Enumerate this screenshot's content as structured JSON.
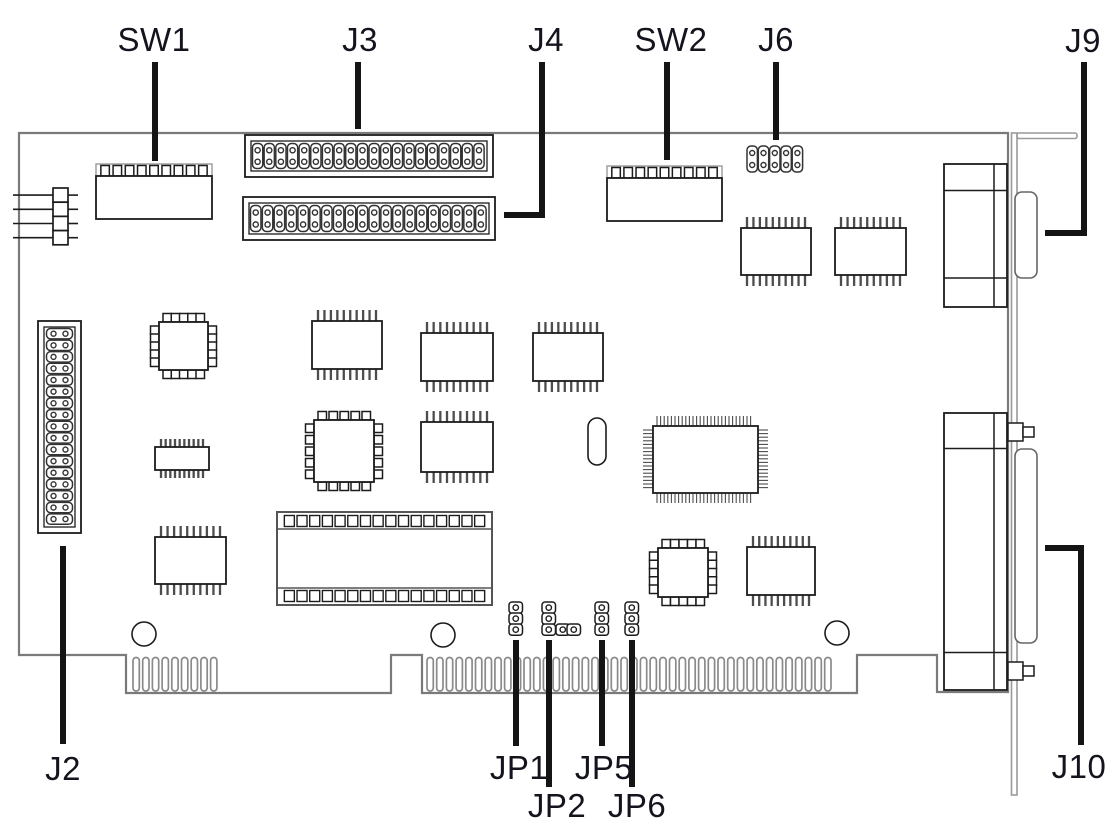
{
  "diagram": {
    "title": "ISA expansion card component location diagram",
    "colors": {
      "background": "#ffffff",
      "board_stroke": "#7a7a7a",
      "component_stroke": "#1c1c1c",
      "pin_stroke": "#4d4d4d",
      "finger_stroke": "#8a8a8a",
      "bracket_stroke": "#9a9a9a",
      "leader_stroke": "#141414",
      "label_text": "#14141e"
    },
    "labels": [
      {
        "id": "sw1",
        "text": "SW1",
        "x": 154,
        "y": 40
      },
      {
        "id": "j3",
        "text": "J3",
        "x": 360,
        "y": 40
      },
      {
        "id": "j4",
        "text": "J4",
        "x": 546,
        "y": 40
      },
      {
        "id": "sw2",
        "text": "SW2",
        "x": 671,
        "y": 40
      },
      {
        "id": "j6",
        "text": "J6",
        "x": 776,
        "y": 40
      },
      {
        "id": "j9",
        "text": "J9",
        "x": 1083,
        "y": 41
      },
      {
        "id": "j2",
        "text": "J2",
        "x": 63,
        "y": 769
      },
      {
        "id": "jp1",
        "text": "JP1",
        "x": 519,
        "y": 768
      },
      {
        "id": "jp2",
        "text": "JP2",
        "x": 557,
        "y": 806
      },
      {
        "id": "jp5",
        "text": "JP5",
        "x": 604,
        "y": 768
      },
      {
        "id": "jp6",
        "text": "JP6",
        "x": 637,
        "y": 806
      },
      {
        "id": "j10",
        "text": "J10",
        "x": 1079,
        "y": 767
      }
    ],
    "leaders": [
      {
        "for": "sw1",
        "points": [
          [
            155,
            62
          ],
          [
            155,
            161
          ]
        ]
      },
      {
        "for": "j3",
        "points": [
          [
            358,
            62
          ],
          [
            358,
            129
          ]
        ]
      },
      {
        "for": "j4",
        "points": [
          [
            542,
            62
          ],
          [
            542,
            215
          ],
          [
            504,
            215
          ]
        ]
      },
      {
        "for": "sw2",
        "points": [
          [
            667,
            62
          ],
          [
            667,
            160
          ]
        ]
      },
      {
        "for": "j6",
        "points": [
          [
            776,
            62
          ],
          [
            776,
            140
          ]
        ]
      },
      {
        "for": "j9",
        "points": [
          [
            1084,
            62
          ],
          [
            1084,
            233
          ],
          [
            1045,
            233
          ]
        ]
      },
      {
        "for": "j2",
        "points": [
          [
            63,
            546
          ],
          [
            63,
            744
          ]
        ]
      },
      {
        "for": "jp1",
        "points": [
          [
            516,
            640
          ],
          [
            516,
            746
          ]
        ]
      },
      {
        "for": "jp2",
        "points": [
          [
            549,
            640
          ],
          [
            549,
            787
          ]
        ]
      },
      {
        "for": "jp5",
        "points": [
          [
            602,
            640
          ],
          [
            602,
            746
          ]
        ]
      },
      {
        "for": "jp6",
        "points": [
          [
            632,
            640
          ],
          [
            632,
            787
          ]
        ]
      },
      {
        "for": "j10",
        "points": [
          [
            1045,
            548
          ],
          [
            1081,
            548
          ],
          [
            1081,
            745
          ]
        ]
      }
    ],
    "board_outline": [
      [
        19,
        133
      ],
      [
        1008,
        133
      ],
      [
        1008,
        692
      ],
      [
        937,
        692
      ],
      [
        937,
        655
      ],
      [
        857,
        655
      ],
      [
        857,
        693
      ],
      [
        422,
        693
      ],
      [
        422,
        655
      ],
      [
        391,
        655
      ],
      [
        391,
        693
      ],
      [
        126,
        693
      ],
      [
        126,
        655
      ],
      [
        19,
        655
      ]
    ],
    "bracket": {
      "x": 1011.5,
      "y": 133,
      "w": 5.5,
      "h": 662,
      "lip_w": 60,
      "lip_h": 5.5
    },
    "edge_connector": {
      "finger_top": 657.5,
      "finger_bottom": 691,
      "finger_w": 6.3,
      "pitch": 9.7,
      "groups": [
        {
          "x": 133,
          "count": 9
        },
        {
          "x": 427,
          "count": 42
        }
      ]
    },
    "connectors": {
      "sw1": {
        "type": "dip-switch",
        "x": 96,
        "y": 164,
        "w": 116,
        "teeth": 9
      },
      "sw2": {
        "type": "dip-switch",
        "x": 607,
        "y": 166,
        "w": 115,
        "teeth": 9
      },
      "j3": {
        "type": "header-2row",
        "x": 245,
        "y": 135,
        "w": 248,
        "h": 42,
        "cols": 20
      },
      "j4": {
        "type": "header-2row",
        "x": 243,
        "y": 197,
        "w": 252,
        "h": 43,
        "cols": 20
      },
      "j6": {
        "type": "pad-strip",
        "x": 747,
        "y": 146,
        "cols": 5
      },
      "j2": {
        "type": "header-vertical",
        "x": 38,
        "y": 321,
        "w": 43,
        "h": 212,
        "rows": 17
      },
      "j9": {
        "type": "dsub",
        "x": 944,
        "y": 164,
        "w": 63,
        "h": 143,
        "lines": [
          190.5,
          278
        ],
        "vline": 994,
        "prot": [
          1015,
          192,
          22,
          86
        ],
        "screws": []
      },
      "j10": {
        "type": "dsub",
        "x": 944,
        "y": 413,
        "w": 63,
        "h": 277,
        "lines": [
          448.5,
          652.5
        ],
        "vline": 994,
        "prot": [
          1015,
          449,
          22,
          194
        ],
        "screws": [
          423,
          662
        ]
      },
      "jp1": {
        "type": "jumper",
        "pads": [
          [
            509,
            602
          ],
          [
            509,
            613
          ],
          [
            509,
            624
          ]
        ]
      },
      "jp2": {
        "type": "jumper",
        "pads": [
          [
            542,
            602
          ],
          [
            542,
            613
          ],
          [
            542,
            624
          ],
          [
            556,
            624
          ],
          [
            567,
            624
          ]
        ]
      },
      "jp5": {
        "type": "jumper",
        "pads": [
          [
            595,
            602
          ],
          [
            595,
            613
          ],
          [
            595,
            624
          ]
        ]
      },
      "jp6": {
        "type": "jumper",
        "pads": [
          [
            625,
            602
          ],
          [
            625,
            613
          ],
          [
            625,
            624
          ]
        ]
      }
    },
    "ics": {
      "dip": [
        {
          "x": 312,
          "y": 321,
          "w": 70,
          "h": 48
        },
        {
          "x": 421,
          "y": 333,
          "w": 72,
          "h": 48
        },
        {
          "x": 533,
          "y": 333,
          "w": 70,
          "h": 48
        },
        {
          "x": 421,
          "y": 422,
          "w": 72,
          "h": 50
        },
        {
          "x": 155,
          "y": 447,
          "w": 54,
          "h": 23,
          "pin_len": 8
        },
        {
          "x": 155,
          "y": 537,
          "w": 71,
          "h": 47
        },
        {
          "x": 741,
          "y": 228,
          "w": 70,
          "h": 47
        },
        {
          "x": 835,
          "y": 228,
          "w": 71,
          "h": 47
        },
        {
          "x": 747,
          "y": 547,
          "w": 68,
          "h": 48
        }
      ],
      "plcc": [
        {
          "x": 159,
          "y": 322,
          "w": 49,
          "h": 48,
          "nt": 5,
          "ns": 5
        },
        {
          "x": 314,
          "y": 420,
          "w": 60,
          "h": 62,
          "nt": 5,
          "ns": 5
        },
        {
          "x": 658,
          "y": 548,
          "w": 50,
          "h": 49,
          "nt": 5,
          "ns": 5
        }
      ],
      "qfp": [
        {
          "x": 653,
          "y": 426,
          "w": 105,
          "h": 67
        }
      ],
      "socket_dip": [
        {
          "x": 277,
          "y": 512,
          "w": 215,
          "h": 93,
          "squares": 16
        }
      ]
    },
    "misc": {
      "resistor_network": {
        "x": 53,
        "y": 188,
        "box_w": 15,
        "box_h": 14.2,
        "count": 4,
        "lead_left_x": 13,
        "lead_right_x": 78
      },
      "oscillator": {
        "x": 588,
        "y": 418,
        "w": 18,
        "h": 47
      },
      "mounting_holes": [
        [
          144,
          634
        ],
        [
          443,
          635
        ],
        [
          837,
          633
        ]
      ],
      "hole_radius": 12
    }
  }
}
